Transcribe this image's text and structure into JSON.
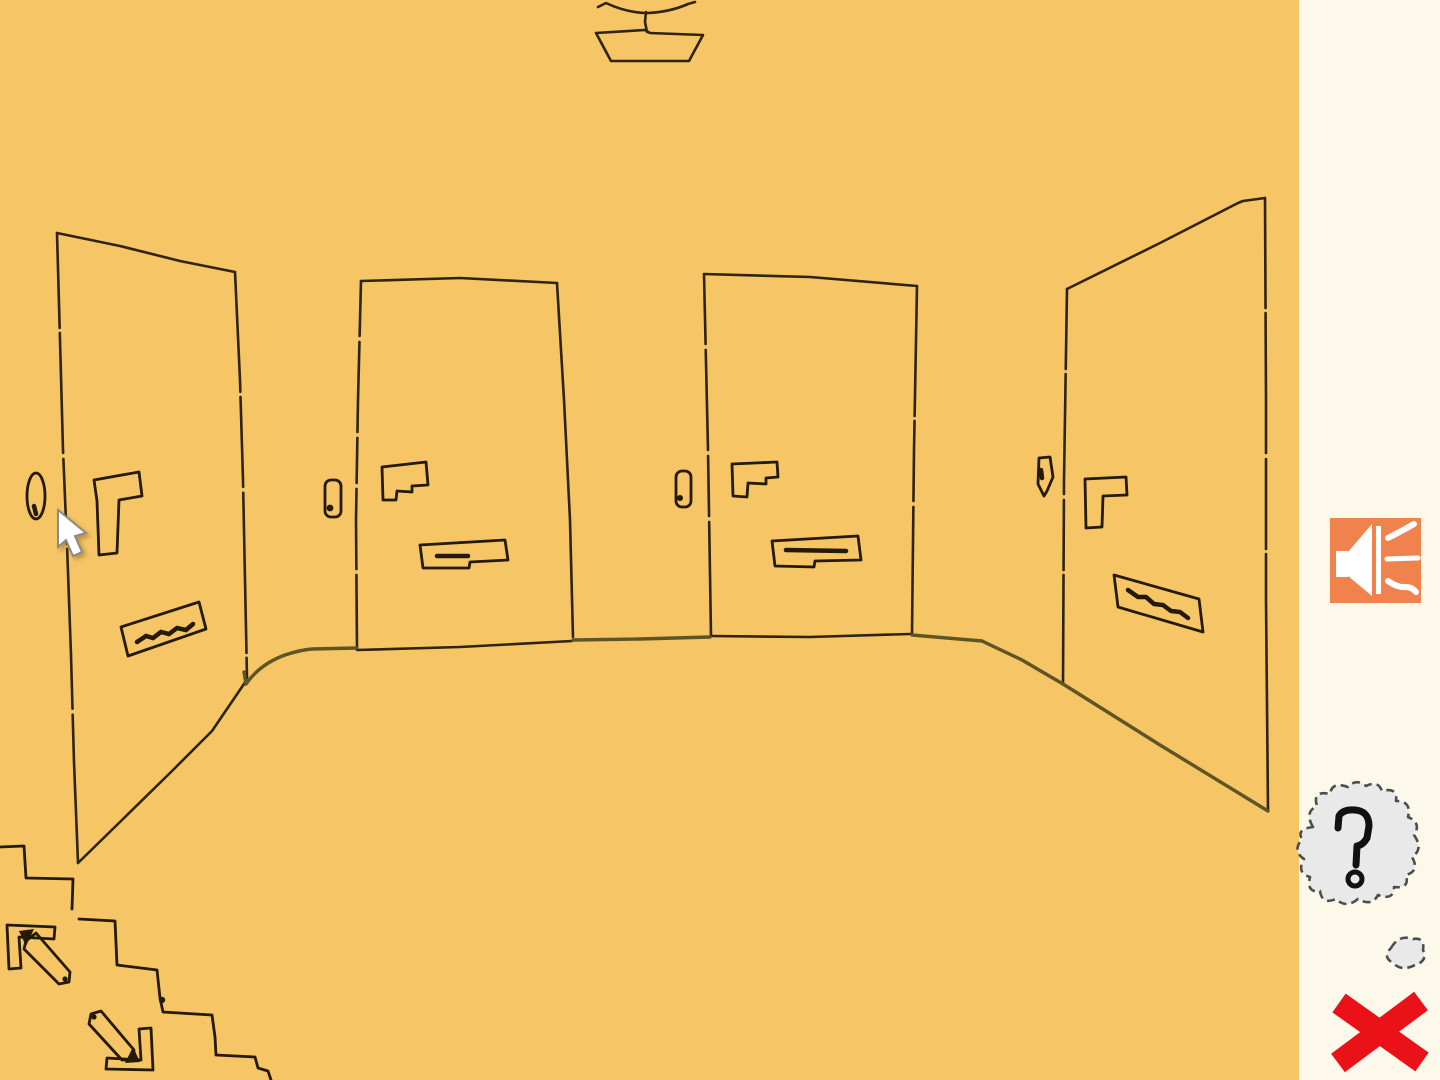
{
  "app": {
    "type": "point-and-click adventure game",
    "view": "hand-drawn hallway with four apartment doors, a ceiling lamp and a staircase going down"
  },
  "colors": {
    "room_background": "#F6C565",
    "line": "#2E2410",
    "detail_line": "#241A06",
    "floor_line": "#5E5524",
    "sidebar_background": "#FCF9EA",
    "sound_button_background": "#F0824D",
    "icon_white": "#FFFFFF",
    "bubble_fill": "#E9E9E9",
    "bubble_border": "#4D4D4D",
    "close_red": "#EA1118",
    "cursor_fill": "#FFFFFF",
    "cursor_outline": "#8A8A8A"
  },
  "scene": {
    "objects": [
      {
        "name": "ceiling-lamp",
        "description": "trapezoid lampshade hanging from curved ceiling line"
      },
      {
        "name": "door-1-left",
        "parts": [
          "doorbell",
          "door-handle",
          "name-plate-scribble"
        ],
        "orientation": "angled left wall"
      },
      {
        "name": "door-2",
        "parts": [
          "doorbell",
          "door-handle",
          "letter-slot"
        ],
        "orientation": "facing front"
      },
      {
        "name": "door-3",
        "parts": [
          "doorbell",
          "door-handle",
          "letter-slot"
        ],
        "orientation": "facing front"
      },
      {
        "name": "door-4-right",
        "parts": [
          "doorbell",
          "door-handle",
          "name-plate-scribble"
        ],
        "orientation": "angled right wall"
      },
      {
        "name": "staircase-down",
        "location": "bottom-left"
      },
      {
        "name": "arrow-up-left",
        "location": "bottom-left"
      },
      {
        "name": "arrow-down-right",
        "location": "bottom-left"
      },
      {
        "name": "mouse-cursor",
        "location": "over left door edge"
      }
    ]
  },
  "sidebar": {
    "sound_button": {
      "icon": "speaker-icon"
    },
    "help_bubble": {
      "icon": "question-mark-icon",
      "glyph": "?"
    },
    "close_button": {
      "icon": "close-x-icon"
    }
  }
}
